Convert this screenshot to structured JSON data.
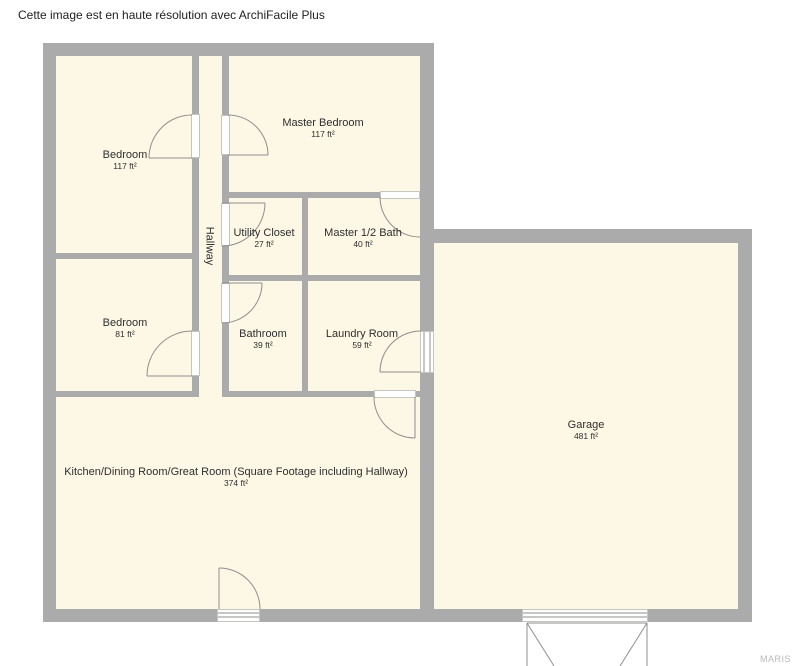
{
  "caption": {
    "text": "Cette image est en haute résolution avec ArchiFacile Plus"
  },
  "watermark": {
    "text": "MARIS"
  },
  "colors": {
    "wall": "#ababab",
    "floor": "#fcf8e5",
    "door_line": "#8f8f8f",
    "label_text": "#2e2e2e",
    "watermark_text": "#b9b9b9"
  },
  "rooms": [
    {
      "id": "bedroom-top",
      "name": "Bedroom",
      "area": "117 ft²"
    },
    {
      "id": "master-bedroom",
      "name": "Master Bedroom",
      "area": "117 ft²"
    },
    {
      "id": "hallway",
      "name": "Hallway",
      "area": ""
    },
    {
      "id": "utility-closet",
      "name": "Utility Closet",
      "area": "27 ft²"
    },
    {
      "id": "master-half-bath",
      "name": "Master 1/2 Bath",
      "area": "40 ft²"
    },
    {
      "id": "bedroom-bottom",
      "name": "Bedroom",
      "area": "81 ft²"
    },
    {
      "id": "bathroom",
      "name": "Bathroom",
      "area": "39 ft²"
    },
    {
      "id": "laundry-room",
      "name": "Laundry Room",
      "area": "59 ft²"
    },
    {
      "id": "great-room",
      "name": "Kitchen/Dining Room/Great Room (Square Footage including Hallway)",
      "area": "374 ft²"
    },
    {
      "id": "garage",
      "name": "Garage",
      "area": "481 ft²"
    }
  ]
}
